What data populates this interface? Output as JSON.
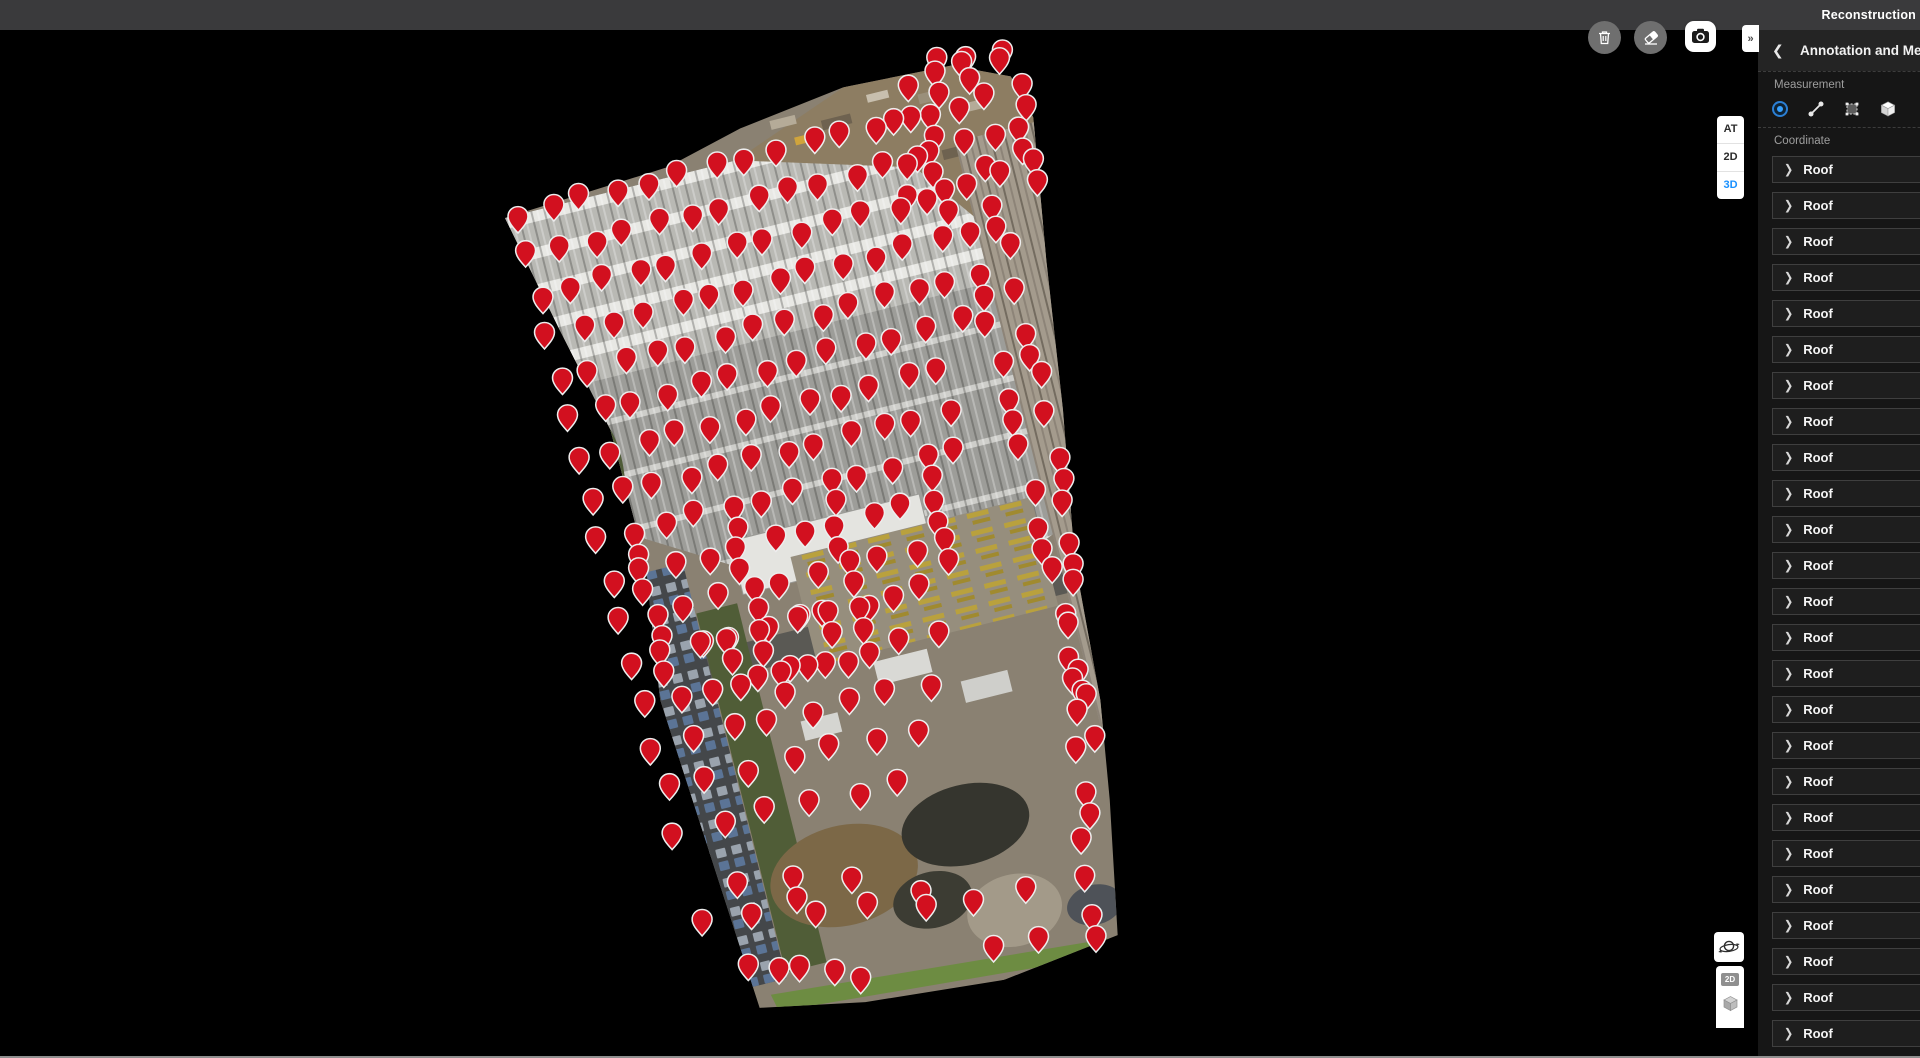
{
  "top_bar": {
    "title": "Reconstruction"
  },
  "toolbar": {
    "buttons": [
      {
        "name": "delete"
      },
      {
        "name": "eraser"
      },
      {
        "name": "screenshot"
      }
    ],
    "collapse_label": "»"
  },
  "view_toggle": {
    "options": [
      {
        "label": "AT",
        "active": false
      },
      {
        "label": "2D",
        "active": false
      },
      {
        "label": "3D",
        "active": true
      }
    ],
    "active_color": "#1890ff"
  },
  "map_controls": {
    "orbit_tooltip": "3d-orbit",
    "layer_2d_label": "2D"
  },
  "sidebar": {
    "back_label": "❮",
    "title": "Annotation and Measurement",
    "measurement_section_label": "Measurement",
    "coordinate_section_label": "Coordinate",
    "measure_tools": [
      {
        "name": "coordinate-point",
        "selected": true
      },
      {
        "name": "distance",
        "selected": false
      },
      {
        "name": "area",
        "selected": false
      },
      {
        "name": "volume",
        "selected": false
      }
    ],
    "item_chevron": "❯",
    "items": [
      {
        "label": "Roof"
      },
      {
        "label": "Roof"
      },
      {
        "label": "Roof"
      },
      {
        "label": "Roof"
      },
      {
        "label": "Roof"
      },
      {
        "label": "Roof"
      },
      {
        "label": "Roof"
      },
      {
        "label": "Roof"
      },
      {
        "label": "Roof"
      },
      {
        "label": "Roof"
      },
      {
        "label": "Roof"
      },
      {
        "label": "Roof"
      },
      {
        "label": "Roof"
      },
      {
        "label": "Roof"
      },
      {
        "label": "Roof"
      },
      {
        "label": "Roof"
      },
      {
        "label": "Roof"
      },
      {
        "label": "Roof"
      },
      {
        "label": "Roof"
      },
      {
        "label": "Roof"
      },
      {
        "label": "Roof"
      },
      {
        "label": "Roof"
      },
      {
        "label": "Roof"
      },
      {
        "label": "Roof"
      },
      {
        "label": "Roof"
      },
      {
        "label": "Roof"
      }
    ]
  },
  "map": {
    "pin_color": "#d2101f",
    "pin_outline": "#ededed",
    "pin_rows": [
      {
        "x": 518,
        "y": 231,
        "dx": 32.5,
        "dy": -8.1,
        "n": 13
      },
      {
        "x": 528,
        "y": 272,
        "dx": 32.5,
        "dy": -8.1,
        "n": 13
      },
      {
        "x": 539,
        "y": 312,
        "dx": 32.5,
        "dy": -8.1,
        "n": 13
      },
      {
        "x": 549,
        "y": 353,
        "dx": 32.5,
        "dy": -8.1,
        "n": 13
      },
      {
        "x": 559,
        "y": 394,
        "dx": 32.5,
        "dy": -8.1,
        "n": 13
      },
      {
        "x": 569,
        "y": 434,
        "dx": 32.5,
        "dy": -8.1,
        "n": 13
      },
      {
        "x": 580,
        "y": 475,
        "dx": 32.5,
        "dy": -8.1,
        "n": 12
      },
      {
        "x": 590,
        "y": 516,
        "dx": 32.5,
        "dy": -8.1,
        "n": 12
      },
      {
        "x": 600,
        "y": 556,
        "dx": 32.5,
        "dy": -8.1,
        "n": 12,
        "d": 1
      },
      {
        "x": 610,
        "y": 597,
        "dx": 32.5,
        "dy": -8.1,
        "n": 11,
        "d": 1
      },
      {
        "x": 621,
        "y": 638,
        "dx": 32.5,
        "dy": -8.1,
        "n": 11,
        "d": 1
      },
      {
        "x": 631,
        "y": 678,
        "dx": 32.5,
        "dy": -8.1,
        "n": 10,
        "d": 1
      },
      {
        "x": 643,
        "y": 722,
        "dx": 37,
        "dy": -9,
        "n": 9
      },
      {
        "x": 654,
        "y": 763,
        "dx": 39,
        "dy": -9,
        "n": 8
      },
      {
        "x": 665,
        "y": 805,
        "dx": 42,
        "dy": -10,
        "n": 7
      },
      {
        "x": 676,
        "y": 848,
        "dx": 45,
        "dy": -10,
        "n": 6
      },
      {
        "x": 700,
        "y": 940,
        "dx": 56,
        "dy": -7,
        "n": 5
      },
      {
        "x": 748,
        "y": 980,
        "dx": 28,
        "dy": 3,
        "n": 5
      },
      {
        "x": 740,
        "y": 901,
        "dx": 54,
        "dy": -4,
        "n": 3,
        "d": 1
      },
      {
        "x": 922,
        "y": 922,
        "dx": 53,
        "dy": -8,
        "n": 3
      },
      {
        "x": 998,
        "y": 963,
        "dx": 37,
        "dy": -5,
        "n": 2
      },
      {
        "x": 700,
        "y": 660,
        "dx": 33,
        "dy": -8,
        "n": 6,
        "d": 1
      },
      {
        "x": 742,
        "y": 700,
        "dx": 35,
        "dy": -8,
        "n": 4,
        "d": 1
      },
      {
        "x": 938,
        "y": 78,
        "dx": 30,
        "dy": -6,
        "n": 3,
        "d": 1
      },
      {
        "x": 905,
        "y": 100,
        "dx": 30,
        "dy": -9,
        "n": 4,
        "d": 1
      },
      {
        "x": 898,
        "y": 140,
        "dx": 30,
        "dy": -9,
        "n": 5,
        "d": 1
      },
      {
        "x": 903,
        "y": 178,
        "dx": 30,
        "dy": -9,
        "n": 5,
        "d": 1
      },
      {
        "x": 910,
        "y": 216,
        "dx": 30,
        "dy": -9,
        "n": 5,
        "d": 1
      },
      {
        "x": 985,
        "y": 180,
        "dx": 10.5,
        "dy": 42,
        "n": 8,
        "d": 1
      },
      {
        "x": 968,
        "y": 252,
        "dx": 10.5,
        "dy": 42,
        "n": 13,
        "d": 1
      },
      {
        "x": 1066,
        "y": 516,
        "dx": 2.2,
        "dy": 42,
        "n": 11,
        "d": 1
      }
    ]
  }
}
